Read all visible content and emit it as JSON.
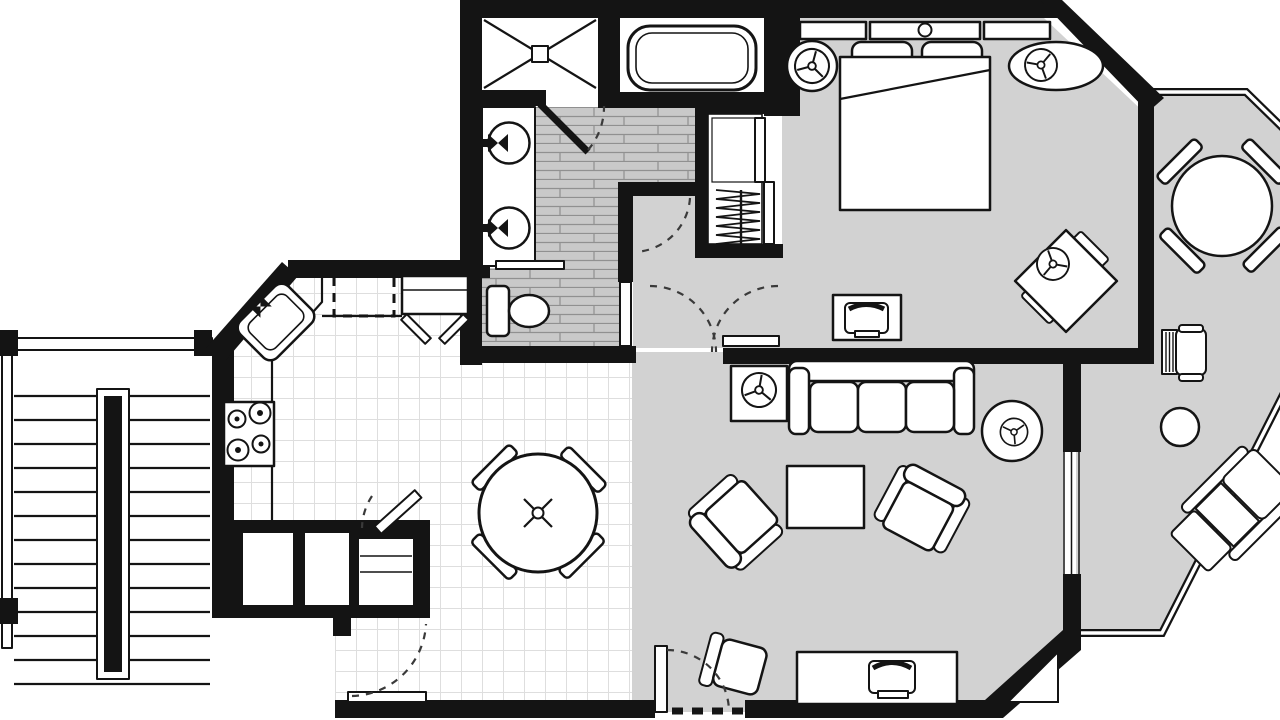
{
  "diagram": {
    "title": "One-bedroom apartment floor plan (top-down architectural drawing)",
    "type": "floor-plan",
    "colors": {
      "walls": "#141414",
      "carpet_floor": "#d2d2d2",
      "tile_floor": "#ffffff",
      "tile_grid_line": "#dedede",
      "plank_floor": "#c9c9c9",
      "plank_line": "#909090",
      "background": "#ffffff"
    },
    "rooms": {
      "bathroom": {
        "label": "Bathroom",
        "floor": "plank tile",
        "fixtures": [
          "corner shower with X pan",
          "bathtub",
          "double sink vanity",
          "toilet",
          "towel shelf",
          "swing door"
        ]
      },
      "closet": {
        "label": "Walk-in closet",
        "fixtures": [
          "hanger rod with hangers",
          "upper shelf",
          "bypass sliding doors"
        ]
      },
      "bedroom": {
        "label": "Bedroom",
        "floor": "carpet",
        "furniture": [
          "queen bed with headboard and pillows",
          "round nightstand with lamp",
          "oval nightstand with lamp",
          "tv cabinet",
          "corner table with two chairs"
        ]
      },
      "hallway": {
        "label": "Hallway",
        "floor": "carpet",
        "features": [
          "door swing arcs",
          "linen nook"
        ]
      },
      "living_room": {
        "label": "Living room",
        "floor": "carpet",
        "furniture": [
          "three-seat sofa",
          "square lamp end table",
          "round lamp end table",
          "coffee table",
          "two armchairs",
          "desk chair",
          "media console with tv",
          "entry door"
        ]
      },
      "kitchen": {
        "label": "Kitchen",
        "floor": "grid tile",
        "fixtures": [
          "corner sink",
          "four-burner cooktop",
          "counter run",
          "dashed overhead cabinet",
          "bifold-door cabinet",
          "utility closets",
          "service door"
        ]
      },
      "dining": {
        "label": "Dining area",
        "floor": "grid tile",
        "furniture": [
          "round dining table with center base",
          "four angled chairs"
        ]
      },
      "stairs": {
        "label": "Exterior stairs",
        "features": [
          "landing",
          "left railing",
          "center handrail"
        ],
        "tread_count": 13
      },
      "balcony": {
        "label": "Wrap-around balcony",
        "floor": "carpet deck",
        "furniture": [
          "round patio table with four chairs",
          "patio chair",
          "round side table",
          "chaise lounge"
        ],
        "features": [
          "octagonal double-line railing"
        ]
      }
    },
    "symbols": {
      "lamp": "circle with three spokes and center hub",
      "table_base": "crossed X with center ring",
      "door_swing": "dashed quarter arc",
      "window": "thin double line in wall"
    }
  }
}
